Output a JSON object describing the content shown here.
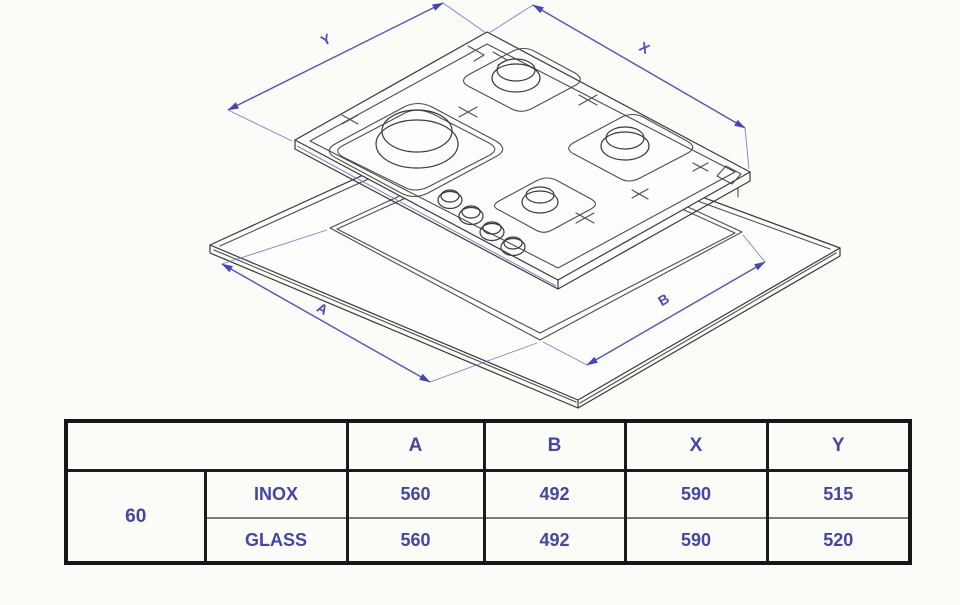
{
  "diagram": {
    "dim_labels": {
      "y": "Y",
      "x": "X",
      "a": "A",
      "b": "B"
    },
    "colors": {
      "dimension_blue": "#5252c2",
      "sketch_gray": "#4d4d4d",
      "table_text_blue": "#4545a8",
      "table_border_black": "#1b1b1b"
    }
  },
  "table": {
    "col_headers": [
      "",
      "A",
      "B",
      "X",
      "Y"
    ],
    "row_group_label": "60",
    "rows": [
      {
        "label": "INOX",
        "values": [
          "560",
          "492",
          "590",
          "515"
        ]
      },
      {
        "label": "GLASS",
        "values": [
          "560",
          "492",
          "590",
          "520"
        ]
      }
    ]
  }
}
